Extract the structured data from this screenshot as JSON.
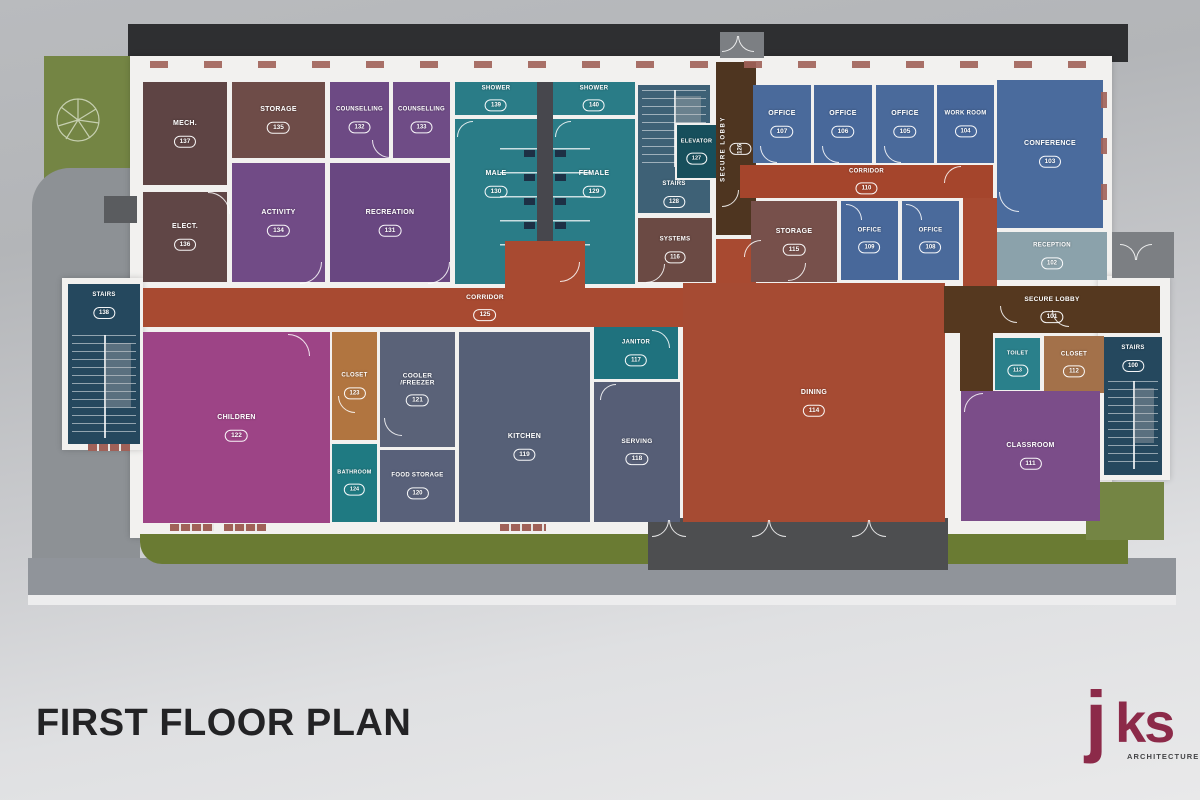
{
  "title": "FIRST FLOOR PLAN",
  "logo": {
    "j": "j",
    "ks": "ks",
    "sub": "ARCHITECTURE"
  },
  "palette": {
    "corridor_red": "#a84a31",
    "secure_brown": "#55381f",
    "office_blue": "#4a6a9b",
    "wet_teal": "#2a7c87",
    "purple": "#714b86",
    "magenta": "#9d4486",
    "slate": "#566077",
    "stairs_navy": "#25485e",
    "closet_tan": "#b17540",
    "storage_brown": "#6e4c48",
    "reception_gray": "#8ba2ab",
    "wall_white": "#f2f1ef",
    "grass_green": "#748544",
    "road_dark": "#2e2f31",
    "logo_maroon": "#8c2a49"
  },
  "rooms": [
    {
      "id": "mech-137",
      "label": "MECH.",
      "number": "137",
      "x": 143,
      "y": 82,
      "w": 84,
      "h": 103,
      "bg": "#5e4444"
    },
    {
      "id": "elect-136",
      "label": "ELECT.",
      "number": "136",
      "x": 143,
      "y": 192,
      "w": 84,
      "h": 90,
      "bg": "#604646"
    },
    {
      "id": "storage-135",
      "label": "STORAGE",
      "number": "135",
      "x": 232,
      "y": 82,
      "w": 93,
      "h": 76,
      "bg": "#6e4c48"
    },
    {
      "id": "activity-134",
      "label": "ACTIVITY",
      "number": "134",
      "x": 232,
      "y": 163,
      "w": 93,
      "h": 119,
      "bg": "#714b86"
    },
    {
      "id": "counselling-132",
      "label": "COUNSELLING",
      "number": "132",
      "x": 330,
      "y": 82,
      "w": 59,
      "h": 76,
      "bg": "#6d4a84",
      "fs": 6
    },
    {
      "id": "counselling-133",
      "label": "COUNSELLING",
      "number": "133",
      "x": 393,
      "y": 82,
      "w": 57,
      "h": 76,
      "bg": "#6f4c86",
      "fs": 6
    },
    {
      "id": "recreation-131",
      "label": "RECREATION",
      "number": "131",
      "x": 330,
      "y": 163,
      "w": 120,
      "h": 119,
      "bg": "#694781"
    },
    {
      "id": "shower-139",
      "label": "SHOWER",
      "number": "139",
      "x": 455,
      "y": 82,
      "w": 82,
      "h": 33,
      "bg": "#2a7c87",
      "fs": 6
    },
    {
      "id": "male-130",
      "label": "MALE",
      "number": "130",
      "x": 455,
      "y": 119,
      "w": 82,
      "h": 165,
      "bg": "#2a7c87",
      "pad": -18
    },
    {
      "id": "shower-140",
      "label": "SHOWER",
      "number": "140",
      "x": 553,
      "y": 82,
      "w": 82,
      "h": 33,
      "bg": "#2a7c87",
      "fs": 6
    },
    {
      "id": "female-129",
      "label": "FEMALE",
      "number": "129",
      "x": 553,
      "y": 119,
      "w": 82,
      "h": 165,
      "bg": "#2a7c87",
      "pad": -18
    },
    {
      "id": "stairs-128",
      "label": "STAIRS",
      "number": "128",
      "x": 638,
      "y": 85,
      "w": 72,
      "h": 128,
      "bg": "#3e6176",
      "stairs": "top",
      "align": "bottom",
      "pad": 5,
      "fs": 6
    },
    {
      "id": "elevator-127",
      "label": "ELEVATOR",
      "number": "127",
      "x": 675,
      "y": 123,
      "w": 43,
      "h": 57,
      "bg": "#174f5c",
      "fs": 5.5,
      "border": true
    },
    {
      "id": "secure-lobby-126",
      "label": "SECURE LOBBY",
      "number": "126",
      "x": 716,
      "y": 62,
      "w": 40,
      "h": 173,
      "bg": "#4e3520",
      "v": true,
      "fs": 6
    },
    {
      "id": "systems-116",
      "label": "SYSTEMS",
      "number": "116",
      "x": 638,
      "y": 218,
      "w": 74,
      "h": 64,
      "bg": "#6b4a44",
      "fs": 6
    },
    {
      "id": "office-107",
      "label": "OFFICE",
      "number": "107",
      "x": 753,
      "y": 85,
      "w": 58,
      "h": 78,
      "bg": "#4a6a9b"
    },
    {
      "id": "office-106",
      "label": "OFFICE",
      "number": "106",
      "x": 814,
      "y": 85,
      "w": 58,
      "h": 78,
      "bg": "#48689a"
    },
    {
      "id": "office-105",
      "label": "OFFICE",
      "number": "105",
      "x": 876,
      "y": 85,
      "w": 58,
      "h": 78,
      "bg": "#4a6a9b"
    },
    {
      "id": "work-room-104",
      "label": "WORK ROOM",
      "number": "104",
      "x": 937,
      "y": 85,
      "w": 57,
      "h": 78,
      "bg": "#47679a",
      "fs": 6
    },
    {
      "id": "corridor-110",
      "label": "CORRIDOR",
      "number": "110",
      "x": 740,
      "y": 165,
      "w": 253,
      "h": 33,
      "bg": "#a5452c",
      "fs": 6
    },
    {
      "id": "conference-103",
      "label": "CONFERENCE",
      "number": "103",
      "x": 997,
      "y": 80,
      "w": 106,
      "h": 148,
      "bg": "#4a6b9d"
    },
    {
      "id": "reception-102",
      "label": "RECEPTION",
      "number": "102",
      "x": 997,
      "y": 232,
      "w": 110,
      "h": 48,
      "bg": "#8ba2ab",
      "fs": 6
    },
    {
      "id": "storage-115",
      "label": "STORAGE",
      "number": "115",
      "x": 751,
      "y": 201,
      "w": 86,
      "h": 81,
      "bg": "#77504b"
    },
    {
      "id": "office-109",
      "label": "OFFICE",
      "number": "109",
      "x": 841,
      "y": 201,
      "w": 57,
      "h": 79,
      "bg": "#48689a",
      "fs": 6
    },
    {
      "id": "office-108",
      "label": "OFFICE",
      "number": "108",
      "x": 902,
      "y": 201,
      "w": 57,
      "h": 79,
      "bg": "#4a6a9b",
      "fs": 6
    },
    {
      "id": "corridor-125",
      "label": "CORRIDOR",
      "number": "125",
      "x": 143,
      "y": 288,
      "w": 547,
      "h": 39,
      "bg": "#a84a31",
      "lx": 342,
      "fs": 6.5
    },
    {
      "id": "stairs-138",
      "label": "STAIRS",
      "number": "138",
      "x": 68,
      "y": 284,
      "w": 72,
      "h": 160,
      "bg": "#25485e",
      "stairs": "bottom",
      "align": "top",
      "pad": 8,
      "fs": 6
    },
    {
      "id": "children-122",
      "label": "CHILDREN",
      "number": "122",
      "x": 143,
      "y": 332,
      "w": 187,
      "h": 191,
      "bg": "#9d4486"
    },
    {
      "id": "closet-123",
      "label": "CLOSET",
      "number": "123",
      "x": 332,
      "y": 332,
      "w": 45,
      "h": 108,
      "bg": "#b17540",
      "fs": 6
    },
    {
      "id": "bathroom-124",
      "label": "BATHROOM",
      "number": "124",
      "x": 332,
      "y": 444,
      "w": 45,
      "h": 78,
      "bg": "#1f7a82",
      "fs": 5.5
    },
    {
      "id": "cooler-freezer-121",
      "label": "COOLER\n/FREEZER",
      "number": "121",
      "x": 380,
      "y": 332,
      "w": 75,
      "h": 115,
      "bg": "#5a6278",
      "fs": 6.5
    },
    {
      "id": "food-storage-120",
      "label": "FOOD STORAGE",
      "number": "120",
      "x": 380,
      "y": 450,
      "w": 75,
      "h": 72,
      "bg": "#59617a",
      "fs": 6
    },
    {
      "id": "kitchen-119",
      "label": "KITCHEN",
      "number": "119",
      "x": 459,
      "y": 332,
      "w": 131,
      "h": 190,
      "bg": "#566077",
      "pad": 20
    },
    {
      "id": "janitor-117",
      "label": "JANITOR",
      "number": "117",
      "x": 594,
      "y": 327,
      "w": 84,
      "h": 52,
      "bg": "#1f727e",
      "fs": 6
    },
    {
      "id": "serving-118",
      "label": "SERVING",
      "number": "118",
      "x": 594,
      "y": 382,
      "w": 86,
      "h": 140,
      "bg": "#565e76",
      "fs": 6.5
    },
    {
      "id": "dining-114",
      "label": "DINING",
      "number": "114",
      "x": 683,
      "y": 283,
      "w": 262,
      "h": 239,
      "bg": "#a64b33"
    },
    {
      "id": "secure-lobby-101",
      "label": "SECURE LOBBY",
      "number": "101",
      "x": 944,
      "y": 286,
      "w": 216,
      "h": 47,
      "bg": "#55381f",
      "fs": 6.5
    },
    {
      "id": "toilet-113",
      "label": "TOILET",
      "number": "113",
      "x": 995,
      "y": 338,
      "w": 45,
      "h": 52,
      "bg": "#2a808b",
      "fs": 5.5
    },
    {
      "id": "closet-112",
      "label": "CLOSET",
      "number": "112",
      "x": 1044,
      "y": 336,
      "w": 60,
      "h": 57,
      "bg": "#a3714a",
      "fs": 6
    },
    {
      "id": "stairs-100",
      "label": "STAIRS",
      "number": "100",
      "x": 1104,
      "y": 337,
      "w": 58,
      "h": 138,
      "bg": "#25485e",
      "stairs": "bottom",
      "align": "top",
      "pad": 8,
      "fs": 6
    },
    {
      "id": "classroom-111",
      "label": "CLASSROOM",
      "number": "111",
      "x": 961,
      "y": 391,
      "w": 139,
      "h": 130,
      "bg": "#7b4d89"
    }
  ]
}
